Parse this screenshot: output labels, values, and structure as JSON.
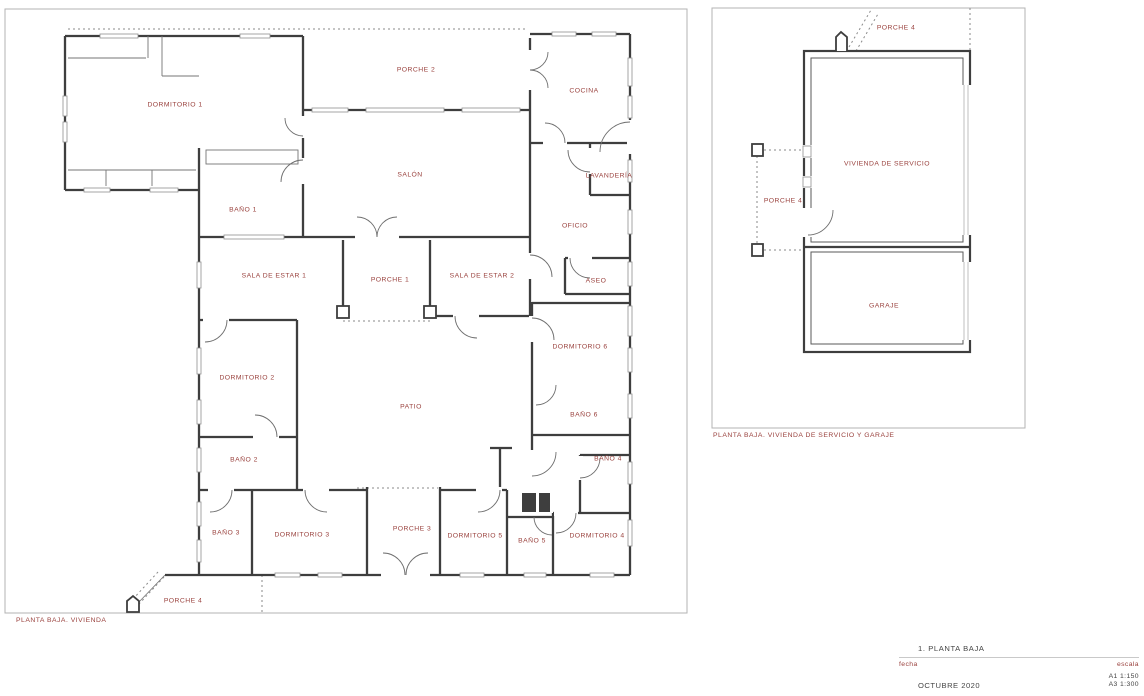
{
  "palette": {
    "label_red": "#9a423e",
    "wall_ink": "#3e3e3e",
    "frame_gray": "#b3b3b3"
  },
  "plan_vivienda": {
    "caption": "PLANTA BAJA. VIVIENDA",
    "rooms": [
      {
        "label": "DORMITORIO 1",
        "x": 175,
        "y": 105
      },
      {
        "label": "PORCHE 2",
        "x": 416,
        "y": 70
      },
      {
        "label": "COCINA",
        "x": 584,
        "y": 91
      },
      {
        "label": "SALÓN",
        "x": 410,
        "y": 175
      },
      {
        "label": "LAVANDERÍA",
        "x": 609,
        "y": 176
      },
      {
        "label": "BAÑO 1",
        "x": 243,
        "y": 210
      },
      {
        "label": "OFICIO",
        "x": 575,
        "y": 226
      },
      {
        "label": "SALA DE ESTAR 1",
        "x": 274,
        "y": 276
      },
      {
        "label": "PORCHE 1",
        "x": 390,
        "y": 280
      },
      {
        "label": "SALA DE ESTAR 2",
        "x": 482,
        "y": 276
      },
      {
        "label": "ASEO",
        "x": 596,
        "y": 281
      },
      {
        "label": "DORMITORIO 6",
        "x": 580,
        "y": 347
      },
      {
        "label": "DORMITORIO 2",
        "x": 247,
        "y": 378
      },
      {
        "label": "PATIO",
        "x": 411,
        "y": 407
      },
      {
        "label": "BAÑO 6",
        "x": 584,
        "y": 415
      },
      {
        "label": "BAÑO 2",
        "x": 244,
        "y": 460
      },
      {
        "label": "BAÑO 4",
        "x": 608,
        "y": 459
      },
      {
        "label": "BAÑO 3",
        "x": 226,
        "y": 533
      },
      {
        "label": "DORMITORIO 3",
        "x": 302,
        "y": 535
      },
      {
        "label": "PORCHE 3",
        "x": 412,
        "y": 529
      },
      {
        "label": "DORMITORIO 5",
        "x": 475,
        "y": 536
      },
      {
        "label": "BAÑO 5",
        "x": 532,
        "y": 541
      },
      {
        "label": "DORMITORIO 4",
        "x": 597,
        "y": 536
      },
      {
        "label": "PORCHE 4",
        "x": 183,
        "y": 601
      }
    ]
  },
  "plan_servicio": {
    "caption": "PLANTA BAJA. VIVIENDA DE SERVICIO Y GARAJE",
    "rooms": [
      {
        "label": "PORCHE 4",
        "x": 896,
        "y": 28
      },
      {
        "label": "VIVIENDA DE SERVICIO",
        "x": 887,
        "y": 164
      },
      {
        "label": "PORCHE 4",
        "x": 783,
        "y": 201
      },
      {
        "label": "GARAJE",
        "x": 884,
        "y": 306
      }
    ]
  },
  "title_block": {
    "title": "1. PLANTA BAJA",
    "date_label": "fecha",
    "date_value": "OCTUBRE 2020",
    "scale_label": "escala",
    "scale_values": [
      "A1 1:150",
      "A3 1:300"
    ]
  }
}
